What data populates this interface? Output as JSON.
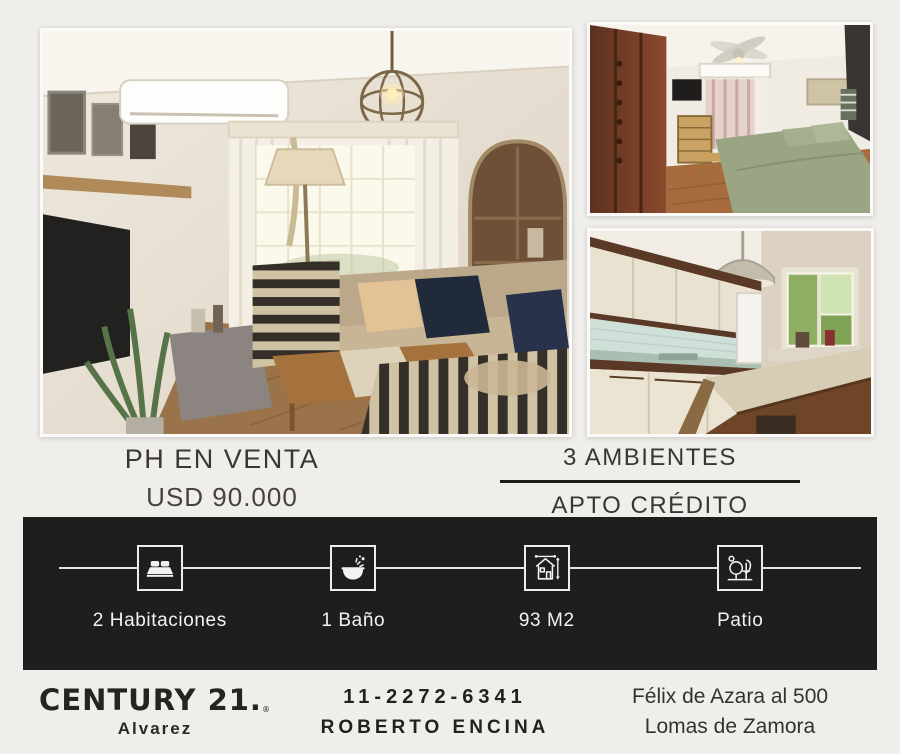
{
  "listing": {
    "title": "PH EN VENTA",
    "price": "USD 90.000",
    "rooms": "3 AMBIENTES",
    "credit": "APTO CRÉDITO"
  },
  "features": [
    {
      "icon": "bed-icon",
      "label": "2 Habitaciones"
    },
    {
      "icon": "bath-icon",
      "label": "1 Baño"
    },
    {
      "icon": "area-icon",
      "label": "93 M2"
    },
    {
      "icon": "patio-icon",
      "label": "Patio"
    }
  ],
  "footer": {
    "brand": "CENTURY 21.",
    "brand_reg": "®",
    "office": "Alvarez",
    "phone": "11-2272-6341",
    "agent": "ROBERTO ENCINA",
    "address_line1": "Félix de Azara al 500",
    "address_line2": "Lomas de Zamora"
  },
  "colors": {
    "page_background": "#f0eeeb",
    "banner_background": "#1f1e1e",
    "banner_text": "#f3f2f1",
    "heading_text": "#3a3836",
    "brand_text": "#262422"
  }
}
